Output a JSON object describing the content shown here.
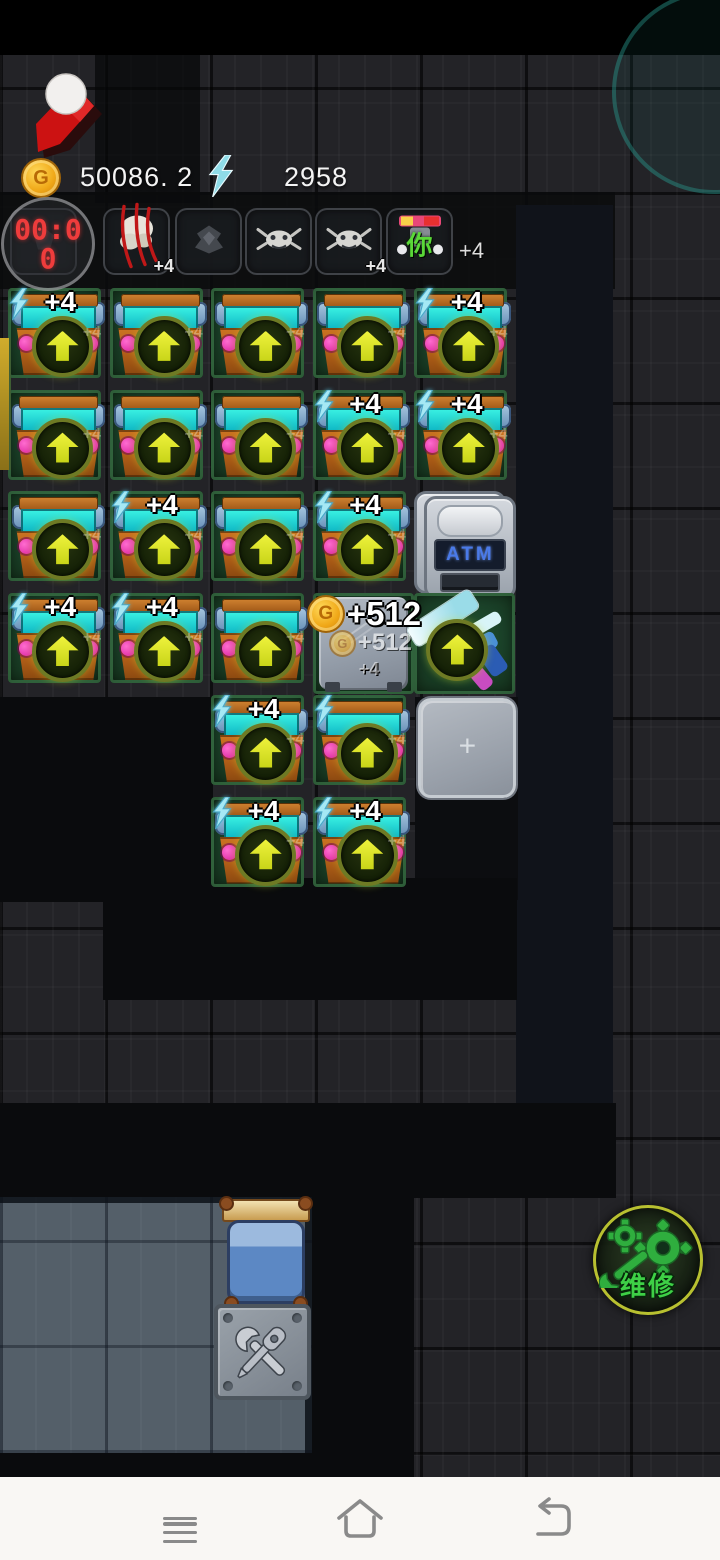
{
  "hud": {
    "coins": "50086. 2",
    "energy": "2958",
    "coin_letter": "G",
    "colors": {
      "coin_gold": "#f0a818",
      "energy_cyan": "#8fdce8",
      "timer_red": "#ee3c3c"
    }
  },
  "timer": {
    "value": "00:00",
    "line1": "00:0",
    "line2": "0"
  },
  "slots": [
    {
      "id": "slot-1",
      "icon": "dim-monster-icon",
      "label": ""
    },
    {
      "id": "slot-2",
      "icon": "clawed-skull-icon",
      "label": "+4"
    },
    {
      "id": "slot-3",
      "icon": "moth-monster-icon",
      "label": ""
    },
    {
      "id": "slot-4",
      "icon": "crab-monster-icon",
      "label": ""
    },
    {
      "id": "slot-5",
      "icon": "crab-monster-icon",
      "label": "+4"
    },
    {
      "id": "slot-6",
      "icon": "boss-banner-icon",
      "label": "",
      "glyph": "你"
    }
  ],
  "slots_suffix": "+4",
  "grid": {
    "columns": 5,
    "rows": 6,
    "atm_label": "ATM",
    "empty_label": "+",
    "chest_watermark": "+4",
    "reward": {
      "main": "+512",
      "echo": "+512",
      "minor": "+4"
    },
    "colors": {
      "lattice_green": "#225434",
      "chest_orange": "#c06a1a",
      "band_cyan": "#14dcd4",
      "arrow_yellow": "#d8e428",
      "gem_magenta": "#e028a8"
    },
    "cells": [
      {
        "r": 1,
        "c": 1,
        "type": "chest",
        "bolt": true,
        "label": "+4"
      },
      {
        "r": 1,
        "c": 2,
        "type": "chest",
        "bolt": false,
        "label": ""
      },
      {
        "r": 1,
        "c": 3,
        "type": "chest",
        "bolt": false,
        "label": ""
      },
      {
        "r": 1,
        "c": 4,
        "type": "chest",
        "bolt": false,
        "label": ""
      },
      {
        "r": 1,
        "c": 5,
        "type": "chest",
        "bolt": true,
        "label": "+4"
      },
      {
        "r": 2,
        "c": 1,
        "type": "chest",
        "bolt": false,
        "label": ""
      },
      {
        "r": 2,
        "c": 2,
        "type": "chest",
        "bolt": false,
        "label": ""
      },
      {
        "r": 2,
        "c": 3,
        "type": "chest",
        "bolt": false,
        "label": ""
      },
      {
        "r": 2,
        "c": 4,
        "type": "chest",
        "bolt": true,
        "label": "+4"
      },
      {
        "r": 2,
        "c": 5,
        "type": "chest",
        "bolt": true,
        "label": "+4"
      },
      {
        "r": 3,
        "c": 1,
        "type": "chest",
        "bolt": false,
        "label": ""
      },
      {
        "r": 3,
        "c": 2,
        "type": "chest",
        "bolt": true,
        "label": "+4"
      },
      {
        "r": 3,
        "c": 3,
        "type": "chest",
        "bolt": false,
        "label": ""
      },
      {
        "r": 3,
        "c": 4,
        "type": "chest",
        "bolt": true,
        "label": "+4"
      },
      {
        "r": 3,
        "c": 5,
        "type": "atm",
        "bolt": false,
        "label": ""
      },
      {
        "r": 4,
        "c": 1,
        "type": "chest",
        "bolt": true,
        "label": "+4"
      },
      {
        "r": 4,
        "c": 2,
        "type": "chest",
        "bolt": true,
        "label": "+4"
      },
      {
        "r": 4,
        "c": 3,
        "type": "chest",
        "bolt": false,
        "label": ""
      },
      {
        "r": 4,
        "c": 4,
        "type": "reward",
        "bolt": false,
        "label": ""
      },
      {
        "r": 4,
        "c": 5,
        "type": "crystal",
        "bolt": false,
        "label": ""
      },
      {
        "r": 5,
        "c": 3,
        "type": "chest",
        "bolt": true,
        "label": "+4"
      },
      {
        "r": 5,
        "c": 4,
        "type": "chest",
        "bolt": true,
        "label": ""
      },
      {
        "r": 5,
        "c": 5,
        "type": "empty",
        "bolt": false,
        "label": ""
      },
      {
        "r": 6,
        "c": 3,
        "type": "chest",
        "bolt": true,
        "label": "+4"
      },
      {
        "r": 6,
        "c": 4,
        "type": "chest",
        "bolt": true,
        "label": "+4"
      }
    ]
  },
  "repair_button": {
    "label": "维修",
    "color": "#3ed046"
  },
  "nav_bar": {
    "icons": [
      "menu",
      "home",
      "back"
    ],
    "background": "#f9f7f4"
  }
}
